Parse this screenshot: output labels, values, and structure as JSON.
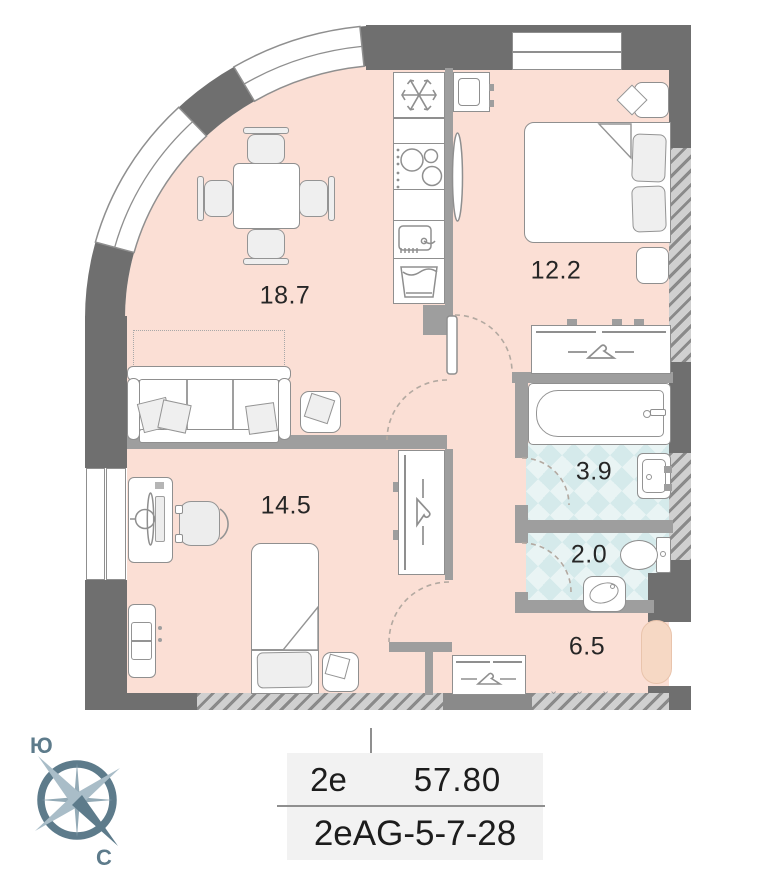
{
  "rooms": {
    "living": {
      "area": "18.7"
    },
    "bedroom": {
      "area": "12.2"
    },
    "bedroom2": {
      "area": "14.5"
    },
    "bathroom": {
      "area": "3.9"
    },
    "wc": {
      "area": "2.0"
    },
    "hallway": {
      "area": "6.5"
    }
  },
  "compass": {
    "south": "Ю",
    "north": "С"
  },
  "info": {
    "layout_type": "2e",
    "total_area": "57.80",
    "apartment_code": "2eAG-5-7-28"
  },
  "colors": {
    "floor": "#fbdfd5",
    "tile": "#e9f4f4",
    "wall_outer": "#6f6f6f",
    "wall_inner": "#9e9e9e",
    "compass_accent": "#5d7b8b",
    "table_bg": "#f2f2f2"
  }
}
